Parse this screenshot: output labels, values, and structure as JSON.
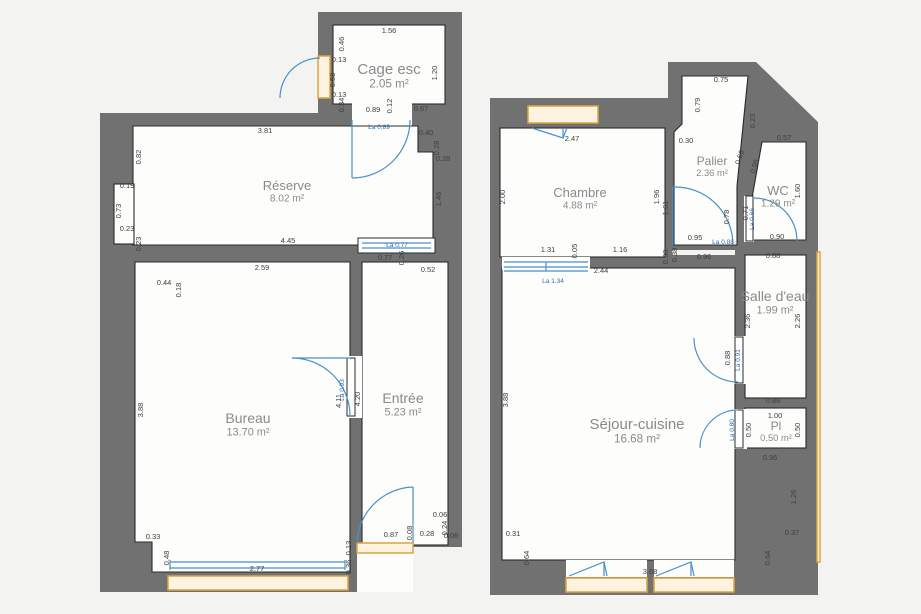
{
  "colors": {
    "background": "#f3f3f1",
    "wall": "#717171",
    "room_fill": "#fdfdfc",
    "outline": "#2a2a2a",
    "door_blue": "#4a90c9",
    "label_blue": "#2f6db5",
    "sill_fill": "#fdf3e0",
    "sill_border": "#d9a63f",
    "dim_text": "#3f3f3f",
    "room_text": "#8a8a8a"
  },
  "plans": [
    {
      "id": "left",
      "rooms": [
        {
          "name": "Cage esc",
          "area": "2.05 m²",
          "x": 389,
          "y": 74,
          "fs": 15
        },
        {
          "name": "Réserve",
          "area": "8.02 m²",
          "x": 287,
          "y": 190,
          "fs": 13
        },
        {
          "name": "Bureau",
          "area": "13.70 m²",
          "x": 248,
          "y": 423,
          "fs": 14
        },
        {
          "name": "Entrée",
          "area": "5.23 m²",
          "x": 403,
          "y": 403,
          "fs": 14
        }
      ],
      "dims": [
        {
          "t": "1.56",
          "x": 389,
          "y": 33
        },
        {
          "t": "0.46",
          "x": 344,
          "y": 44,
          "r": -90
        },
        {
          "t": "0.13",
          "x": 339,
          "y": 62
        },
        {
          "t": "0.53",
          "x": 335,
          "y": 80,
          "r": -90
        },
        {
          "t": "0.13",
          "x": 339,
          "y": 97
        },
        {
          "t": "1.20",
          "x": 437,
          "y": 73,
          "r": -90
        },
        {
          "t": "0.34",
          "x": 344,
          "y": 105,
          "r": -90
        },
        {
          "t": "0.89",
          "x": 373,
          "y": 112
        },
        {
          "t": "0.12",
          "x": 392,
          "y": 106,
          "r": -90
        },
        {
          "t": "0.67",
          "x": 421,
          "y": 111
        },
        {
          "t": "0.40",
          "x": 426,
          "y": 135
        },
        {
          "t": "0.28",
          "x": 439,
          "y": 148,
          "r": -90
        },
        {
          "t": "0.28",
          "x": 443,
          "y": 161
        },
        {
          "t": "3.81",
          "x": 265,
          "y": 133
        },
        {
          "t": "0.82",
          "x": 141,
          "y": 157,
          "r": -90
        },
        {
          "t": "1.46",
          "x": 441,
          "y": 199,
          "r": -90
        },
        {
          "t": "0.19",
          "x": 127,
          "y": 188
        },
        {
          "t": "0.73",
          "x": 121,
          "y": 211,
          "r": -90
        },
        {
          "t": "0.23",
          "x": 127,
          "y": 231
        },
        {
          "t": "0.23",
          "x": 141,
          "y": 244,
          "r": -90
        },
        {
          "t": "4.45",
          "x": 288,
          "y": 243
        },
        {
          "t": "0.77",
          "x": 385,
          "y": 260
        },
        {
          "t": "0.26",
          "x": 404,
          "y": 258,
          "r": -90
        },
        {
          "t": "0.52",
          "x": 428,
          "y": 272
        },
        {
          "t": "2.59",
          "x": 262,
          "y": 270
        },
        {
          "t": "0.44",
          "x": 164,
          "y": 285
        },
        {
          "t": "0.18",
          "x": 181,
          "y": 290,
          "r": -90
        },
        {
          "t": "3.88",
          "x": 143,
          "y": 410,
          "r": -90
        },
        {
          "t": "4.11",
          "x": 341,
          "y": 401,
          "r": -90
        },
        {
          "t": "4.20",
          "x": 360,
          "y": 399,
          "r": -90
        },
        {
          "t": "0.33",
          "x": 153,
          "y": 539
        },
        {
          "t": "0.48",
          "x": 169,
          "y": 558,
          "r": -90
        },
        {
          "t": "2.77",
          "x": 257,
          "y": 571
        },
        {
          "t": "0.36",
          "x": 351,
          "y": 567,
          "r": -90
        },
        {
          "t": "0.13",
          "x": 351,
          "y": 548,
          "r": -90
        },
        {
          "t": "0.87",
          "x": 391,
          "y": 537
        },
        {
          "t": "0.08",
          "x": 412,
          "y": 533,
          "r": -90
        },
        {
          "t": "0.28",
          "x": 427,
          "y": 536
        },
        {
          "t": "0.06",
          "x": 440,
          "y": 517
        },
        {
          "t": "0.24",
          "x": 447,
          "y": 528,
          "r": -90
        },
        {
          "t": "0.06",
          "x": 451,
          "y": 538
        }
      ],
      "door_labels": [
        {
          "t": "La 0.89",
          "x": 379,
          "y": 129
        },
        {
          "t": "La 0.77",
          "x": 397,
          "y": 247
        },
        {
          "t": "La 0.93",
          "x": 344,
          "y": 390,
          "r": -90
        }
      ]
    },
    {
      "id": "right",
      "rooms": [
        {
          "name": "Chambre",
          "area": "4.88 m²",
          "x": 580,
          "y": 197,
          "fs": 13
        },
        {
          "name": "Palier",
          "area": "2.36 m²",
          "x": 712,
          "y": 165,
          "fs": 12
        },
        {
          "name": "WC",
          "area": "1.29 m²",
          "x": 778,
          "y": 195,
          "fs": 13
        },
        {
          "name": "Salle d'eau",
          "area": "1.99 m²",
          "x": 775,
          "y": 301,
          "fs": 14
        },
        {
          "name": "Séjour-cuisine",
          "area": "16.68 m²",
          "x": 637,
          "y": 429,
          "fs": 15
        },
        {
          "name": "Pl",
          "area": "0.50 m²",
          "x": 776,
          "y": 430,
          "fs": 12
        }
      ],
      "dims": [
        {
          "t": "2.47",
          "x": 572,
          "y": 141
        },
        {
          "t": "2.00",
          "x": 505,
          "y": 197,
          "r": -90
        },
        {
          "t": "1.96",
          "x": 659,
          "y": 197,
          "r": -90
        },
        {
          "t": "0.30",
          "x": 686,
          "y": 143
        },
        {
          "t": "0.75",
          "x": 721,
          "y": 82
        },
        {
          "t": "0.79",
          "x": 700,
          "y": 105,
          "r": -90
        },
        {
          "t": "0.23",
          "x": 755,
          "y": 121,
          "r": -90
        },
        {
          "t": "0.57",
          "x": 784,
          "y": 140
        },
        {
          "t": "0.66",
          "x": 742,
          "y": 158,
          "r": -72
        },
        {
          "t": "0.95",
          "x": 757,
          "y": 167,
          "r": -72
        },
        {
          "t": "1.61",
          "x": 668,
          "y": 208,
          "r": -90
        },
        {
          "t": "0.78",
          "x": 729,
          "y": 217,
          "r": -90
        },
        {
          "t": "0.71",
          "x": 748,
          "y": 213,
          "r": -90
        },
        {
          "t": "1.60",
          "x": 800,
          "y": 191,
          "r": -90
        },
        {
          "t": "0.90",
          "x": 777,
          "y": 239
        },
        {
          "t": "0.95",
          "x": 695,
          "y": 240
        },
        {
          "t": "0.96",
          "x": 704,
          "y": 259
        },
        {
          "t": "0.38",
          "x": 668,
          "y": 257,
          "r": -90
        },
        {
          "t": "1.31",
          "x": 548,
          "y": 252
        },
        {
          "t": "0.05",
          "x": 577,
          "y": 251,
          "r": -90
        },
        {
          "t": "1.16",
          "x": 620,
          "y": 252
        },
        {
          "t": "0.38",
          "x": 677,
          "y": 255,
          "r": -90
        },
        {
          "t": "2.44",
          "x": 601,
          "y": 273
        },
        {
          "t": "0.88",
          "x": 773,
          "y": 258
        },
        {
          "t": "2.36",
          "x": 750,
          "y": 321,
          "r": -90
        },
        {
          "t": "2.26",
          "x": 800,
          "y": 321,
          "r": -90
        },
        {
          "t": "0.88",
          "x": 730,
          "y": 358,
          "r": -90
        },
        {
          "t": "0.88",
          "x": 773,
          "y": 403
        },
        {
          "t": "1.00",
          "x": 775,
          "y": 418
        },
        {
          "t": "0.50",
          "x": 751,
          "y": 430,
          "r": -90
        },
        {
          "t": "0.50",
          "x": 800,
          "y": 430,
          "r": -90
        },
        {
          "t": "0.96",
          "x": 770,
          "y": 460
        },
        {
          "t": "1.26",
          "x": 796,
          "y": 497,
          "r": -90
        },
        {
          "t": "3.88",
          "x": 508,
          "y": 400,
          "r": -90
        },
        {
          "t": "0.31",
          "x": 513,
          "y": 536
        },
        {
          "t": "0.64",
          "x": 529,
          "y": 558,
          "r": -90
        },
        {
          "t": "3.68",
          "x": 650,
          "y": 574
        },
        {
          "t": "0.64",
          "x": 770,
          "y": 558,
          "r": -90
        },
        {
          "t": "0.37",
          "x": 792,
          "y": 535
        }
      ],
      "door_labels": [
        {
          "t": "La 1.34",
          "x": 553,
          "y": 283
        },
        {
          "t": "La 0.88",
          "x": 723,
          "y": 244
        },
        {
          "t": "La 0.66",
          "x": 754,
          "y": 219,
          "r": -90
        },
        {
          "t": "La 0.91",
          "x": 740,
          "y": 360,
          "r": -90
        },
        {
          "t": "La 0.80",
          "x": 734,
          "y": 430,
          "r": -90
        }
      ]
    }
  ]
}
